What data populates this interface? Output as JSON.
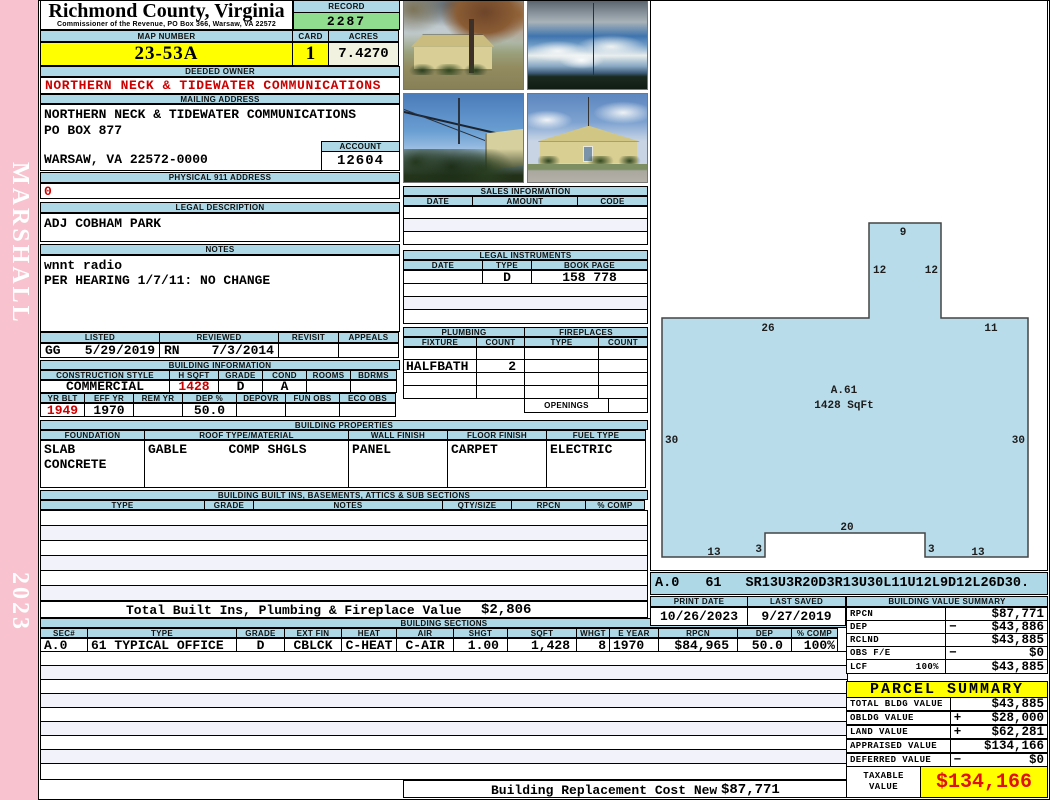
{
  "page": {
    "strip_top": "MARSHALL",
    "strip_bottom": "2023"
  },
  "header": {
    "county": "Richmond County, Virginia",
    "office": "Commissioner of the Revenue, PO Box 366, Warsaw, VA 22572",
    "record_label": "RECORD",
    "record": "2287",
    "map_label": "MAP NUMBER",
    "map_number": "23-53A",
    "card_label": "CARD",
    "card": "1",
    "acres_label": "ACRES",
    "acres": "7.4270"
  },
  "owner": {
    "label": "DEEDED OWNER",
    "name": "NORTHERN NECK & TIDEWATER COMMUNICATIONS"
  },
  "mailing": {
    "label": "MAILING ADDRESS",
    "line1": "NORTHERN NECK & TIDEWATER COMMUNICATIONS",
    "line2": "PO BOX 877",
    "line3": "WARSAW, VA 22572-0000",
    "account_label": "ACCOUNT",
    "account": "12604"
  },
  "physical": {
    "label": "PHYSICAL 911 ADDRESS",
    "value": "0"
  },
  "legal": {
    "label": "LEGAL DESCRIPTION",
    "value": "ADJ COBHAM PARK"
  },
  "notes": {
    "label": "NOTES",
    "line1": "wnnt radio",
    "line2": "PER HEARING 1/7/11: NO CHANGE"
  },
  "review": {
    "headers": [
      "LISTED",
      "REVIEWED",
      "REVISIT",
      "APPEALS"
    ],
    "listed_by": "GG",
    "listed_date": "5/29/2019",
    "reviewed_by": "RN",
    "reviewed_date": "7/3/2014"
  },
  "building_info": {
    "title": "BUILDING INFORMATION",
    "row1_headers": [
      "CONSTRUCTION STYLE",
      "H SQFT",
      "GRADE",
      "COND",
      "ROOMS",
      "BDRMS"
    ],
    "style": "COMMERCIAL",
    "hsqft": "1428",
    "grade": "D",
    "cond": "A",
    "row2_headers": [
      "YR BLT",
      "EFF YR",
      "REM YR",
      "DEP %",
      "DEPOVR",
      "FUN OBS",
      "ECO OBS"
    ],
    "yr_blt": "1949",
    "eff_yr": "1970",
    "dep_pct": "50.0"
  },
  "sales": {
    "title": "SALES INFORMATION",
    "headers": [
      "DATE",
      "AMOUNT",
      "CODE"
    ]
  },
  "instruments": {
    "title": "LEGAL INSTRUMENTS",
    "headers": [
      "DATE",
      "TYPE",
      "BOOK PAGE"
    ],
    "row": {
      "type": "D",
      "book_page": "158 778"
    }
  },
  "plumbing": {
    "title": "PLUMBING",
    "headers": [
      "FIXTURE",
      "COUNT"
    ],
    "row": {
      "fixture": "HALFBATH",
      "count": "2"
    }
  },
  "fireplaces": {
    "title": "FIREPLACES",
    "headers": [
      "TYPE",
      "COUNT"
    ],
    "openings_label": "OPENINGS"
  },
  "properties": {
    "title": "BUILDING PROPERTIES",
    "headers": [
      "FOUNDATION",
      "ROOF TYPE/MATERIAL",
      "WALL FINISH",
      "FLOOR FINISH",
      "FUEL TYPE"
    ],
    "foundation1": "SLAB",
    "foundation2": "CONCRETE",
    "roof_type": "GABLE",
    "roof_material": "COMP SHGLS",
    "wall": "PANEL",
    "floor": "CARPET",
    "fuel": "ELECTRIC"
  },
  "builtins": {
    "title": "BUILDING BUILT INS, BASEMENTS, ATTICS & SUB SECTIONS",
    "headers": [
      "TYPE",
      "GRADE",
      "NOTES",
      "QTY/SIZE",
      "RPCN",
      "% COMP"
    ]
  },
  "totals": {
    "built_label": "Total Built Ins, Plumbing & Fireplace Value",
    "built_value": "$2,806",
    "replacement_label": "Building Replacement Cost New",
    "replacement_value": "$87,771"
  },
  "sections": {
    "title": "BUILDING SECTIONS",
    "headers": [
      "SEC#",
      "TYPE",
      "GRADE",
      "EXT FIN",
      "HEAT",
      "AIR",
      "SHGT",
      "SQFT",
      "WHGT",
      "E YEAR",
      "RPCN",
      "DEP",
      "% COMP"
    ],
    "row": {
      "sec": "A.0",
      "type": "61 TYPICAL OFFICE",
      "grade": "D",
      "ext_fin": "CBLCK",
      "heat": "C-HEAT",
      "air": "C-AIR",
      "shgt": "1.00",
      "sqft": "1,428",
      "whgt": "8",
      "e_year": "1970",
      "rpcn": "$84,965",
      "dep": "50.0",
      "comp": "100%"
    }
  },
  "sketch": {
    "section": "A.0",
    "number": "61",
    "trace": "SR13U3R20D3R13U30L11U12L9D12L26D30.",
    "labels": {
      "top": "9",
      "stem_left": "12",
      "stem_right": "12",
      "upper_left": "26",
      "upper_right": "11",
      "left": "30",
      "right": "30",
      "notch_top": "20",
      "notch_left": "3",
      "notch_right": "3",
      "bottom_left": "13",
      "bottom_right": "13",
      "area_id": "A.61",
      "area_sqft": "1428 SqFt"
    }
  },
  "meta_dates": {
    "print_label": "PRINT DATE",
    "print": "10/26/2023",
    "saved_label": "LAST SAVED",
    "saved": "9/27/2019"
  },
  "bvs": {
    "title": "BUILDING VALUE SUMMARY",
    "rows": [
      {
        "label": "RPCN",
        "op": "",
        "value": "$87,771"
      },
      {
        "label": "DEP",
        "op": "−",
        "value": "$43,886"
      },
      {
        "label": "RCLND",
        "op": "",
        "value": "$43,885"
      },
      {
        "label": "OBS F/E",
        "op": "−",
        "value": "$0"
      },
      {
        "label": "LCF",
        "pct": "100%",
        "op": "",
        "value": "$43,885"
      }
    ]
  },
  "parcel": {
    "title": "PARCEL SUMMARY",
    "rows": [
      {
        "label": "TOTAL BLDG VALUE",
        "op": "",
        "value": "$43,885"
      },
      {
        "label": "OBLDG VALUE",
        "op": "+",
        "value": "$28,000"
      },
      {
        "label": "LAND VALUE",
        "op": "+",
        "value": "$62,281"
      },
      {
        "label": "APPRAISED VALUE",
        "op": "",
        "value": "$134,166"
      },
      {
        "label": "DEFERRED VALUE",
        "op": "−",
        "value": "$0"
      }
    ],
    "taxable_label1": "TAXABLE",
    "taxable_label2": "VALUE",
    "taxable_value": "$134,166"
  },
  "colors": {
    "accent_blue": "#aed8e6",
    "record_green": "#90dd90",
    "highlight_yellow": "#ffff00",
    "value_red": "#cc0000",
    "strip_pink": "#f8c3ce",
    "sketch_fill": "#b9dcea"
  }
}
